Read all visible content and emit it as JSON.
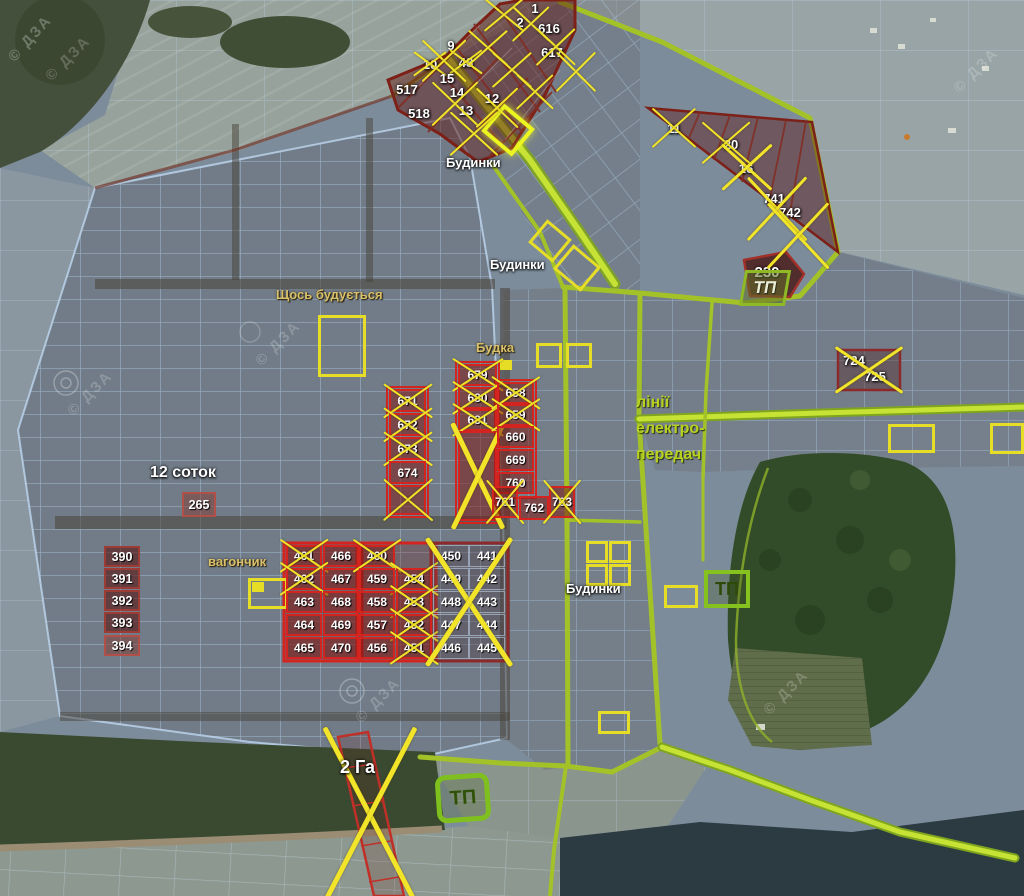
{
  "map_title": "Кадастрова схема земельних ділянок",
  "watermark_text": "© ДЗА",
  "colors": {
    "boundary_green": "#b6d42e",
    "crossed_yellow": "#f2e428",
    "plot_red": "#d42420",
    "plot_darkred": "#8b2a2a",
    "label_khaki": "#d9c06a",
    "power_line_green": "#b8d020"
  },
  "labels": [
    {
      "text": "Будинки",
      "x": 446,
      "y": 156,
      "cls": "white"
    },
    {
      "text": "Будинки",
      "x": 490,
      "y": 258,
      "cls": "white"
    },
    {
      "text": "Будинки",
      "x": 566,
      "y": 582,
      "cls": "white"
    },
    {
      "text": "Щось будується",
      "x": 276,
      "y": 288,
      "cls": "khaki"
    },
    {
      "text": "Будка",
      "x": 476,
      "y": 341,
      "cls": "khaki"
    },
    {
      "text": "вагончик",
      "x": 208,
      "y": 555,
      "cls": "khaki"
    },
    {
      "text": "12 соток",
      "x": 150,
      "y": 464,
      "cls": "big"
    },
    {
      "text": "2 Га",
      "x": 340,
      "y": 758,
      "cls": "big2"
    },
    {
      "text": "лінії",
      "x": 636,
      "y": 394,
      "cls": "green"
    },
    {
      "text": "електро-",
      "x": 636,
      "y": 420,
      "cls": "green"
    },
    {
      "text": "передач",
      "x": 636,
      "y": 446,
      "cls": "green"
    }
  ],
  "tp_stations": [
    {
      "label": "ТП",
      "x": 742,
      "y": 270,
      "w": 46,
      "h": 36,
      "variant": "trap"
    },
    {
      "label": "ТП",
      "x": 704,
      "y": 570,
      "w": 46,
      "h": 38,
      "variant": "square"
    },
    {
      "label": "ТП",
      "x": 436,
      "y": 774,
      "w": 54,
      "h": 48,
      "variant": "round"
    }
  ],
  "plots": [
    {
      "n": "1",
      "x": 526,
      "y": 1,
      "w": 18,
      "h": 14,
      "box": "bare",
      "crossed": false
    },
    {
      "n": "2",
      "x": 512,
      "y": 15,
      "w": 16,
      "h": 14,
      "box": "bare",
      "crossed": false
    },
    {
      "n": "616",
      "x": 534,
      "y": 21,
      "w": 30,
      "h": 15,
      "box": "bare",
      "crossed": false
    },
    {
      "n": "617",
      "x": 537,
      "y": 45,
      "w": 30,
      "h": 15,
      "box": "bare",
      "crossed": false
    },
    {
      "n": "9",
      "x": 443,
      "y": 38,
      "w": 16,
      "h": 14,
      "box": "bare",
      "crossed": false
    },
    {
      "n": "10",
      "x": 419,
      "y": 57,
      "w": 22,
      "h": 14,
      "box": "bare",
      "crossed": true
    },
    {
      "n": "48",
      "x": 455,
      "y": 55,
      "w": 22,
      "h": 14,
      "box": "bare",
      "crossed": true
    },
    {
      "n": "15",
      "x": 436,
      "y": 71,
      "w": 22,
      "h": 15,
      "box": "bare",
      "crossed": false
    },
    {
      "n": "14",
      "x": 446,
      "y": 85,
      "w": 22,
      "h": 14,
      "box": "bare",
      "crossed": false
    },
    {
      "n": "12",
      "x": 482,
      "y": 91,
      "w": 20,
      "h": 14,
      "box": "bare",
      "crossed": false
    },
    {
      "n": "13",
      "x": 455,
      "y": 103,
      "w": 22,
      "h": 14,
      "box": "bare",
      "crossed": false
    },
    {
      "n": "517",
      "x": 391,
      "y": 81,
      "w": 32,
      "h": 16,
      "box": "bare",
      "crossed": false
    },
    {
      "n": "518",
      "x": 403,
      "y": 105,
      "w": 32,
      "h": 16,
      "box": "bare",
      "crossed": false
    },
    {
      "n": "11",
      "x": 664,
      "y": 121,
      "w": 20,
      "h": 15,
      "box": "bare",
      "crossed": false
    },
    {
      "n": "20",
      "x": 720,
      "y": 137,
      "w": 22,
      "h": 15,
      "box": "bare",
      "crossed": false
    },
    {
      "n": "16",
      "x": 736,
      "y": 161,
      "w": 20,
      "h": 15,
      "box": "bare",
      "crossed": false
    },
    {
      "n": "741",
      "x": 760,
      "y": 191,
      "w": 28,
      "h": 15,
      "box": "bare",
      "crossed": false
    },
    {
      "n": "742",
      "x": 776,
      "y": 205,
      "w": 28,
      "h": 15,
      "box": "bare",
      "crossed": false
    },
    {
      "n": "230",
      "x": 750,
      "y": 263,
      "w": 34,
      "h": 18,
      "box": "bare-lg",
      "crossed": false
    },
    {
      "n": "724",
      "x": 841,
      "y": 353,
      "w": 26,
      "h": 14,
      "box": "bare",
      "crossed": false
    },
    {
      "n": "725",
      "x": 862,
      "y": 369,
      "w": 26,
      "h": 14,
      "box": "bare",
      "crossed": false
    },
    {
      "n": "671",
      "x": 389,
      "y": 389,
      "w": 37,
      "h": 23,
      "box": "red",
      "crossed": true
    },
    {
      "n": "672",
      "x": 389,
      "y": 413,
      "w": 37,
      "h": 23,
      "box": "red",
      "crossed": true
    },
    {
      "n": "673",
      "x": 389,
      "y": 437,
      "w": 37,
      "h": 23,
      "box": "red",
      "crossed": true
    },
    {
      "n": "674",
      "x": 389,
      "y": 461,
      "w": 37,
      "h": 23,
      "box": "red",
      "crossed": false
    },
    {
      "n": "",
      "x": 389,
      "y": 485,
      "w": 37,
      "h": 30,
      "box": "red",
      "crossed": true
    },
    {
      "n": "679",
      "x": 458,
      "y": 364,
      "w": 39,
      "h": 22,
      "box": "red",
      "crossed": true
    },
    {
      "n": "680",
      "x": 458,
      "y": 387,
      "w": 39,
      "h": 22,
      "box": "red",
      "crossed": true
    },
    {
      "n": "681",
      "x": 458,
      "y": 409,
      "w": 39,
      "h": 22,
      "box": "red",
      "crossed": true
    },
    {
      "n": "",
      "x": 458,
      "y": 431,
      "w": 39,
      "h": 90,
      "box": "red",
      "crossed": true
    },
    {
      "n": "658",
      "x": 497,
      "y": 382,
      "w": 37,
      "h": 22,
      "box": "red",
      "crossed": true
    },
    {
      "n": "659",
      "x": 497,
      "y": 404,
      "w": 37,
      "h": 22,
      "box": "red",
      "crossed": true
    },
    {
      "n": "660",
      "x": 497,
      "y": 426,
      "w": 37,
      "h": 22,
      "box": "red",
      "crossed": false
    },
    {
      "n": "669",
      "x": 497,
      "y": 449,
      "w": 37,
      "h": 22,
      "box": "red",
      "crossed": false
    },
    {
      "n": "760",
      "x": 497,
      "y": 472,
      "w": 37,
      "h": 22,
      "box": "red",
      "crossed": false
    },
    {
      "n": "761",
      "x": 492,
      "y": 486,
      "w": 26,
      "h": 32,
      "box": "red",
      "crossed": true
    },
    {
      "n": "762",
      "x": 519,
      "y": 496,
      "w": 30,
      "h": 24,
      "box": "red",
      "crossed": false
    },
    {
      "n": "763",
      "x": 549,
      "y": 486,
      "w": 26,
      "h": 32,
      "box": "red",
      "crossed": true
    },
    {
      "n": "265",
      "x": 182,
      "y": 492,
      "w": 34,
      "h": 25,
      "box": "darkred2",
      "crossed": false
    },
    {
      "n": "390",
      "x": 104,
      "y": 546,
      "w": 36,
      "h": 21,
      "box": "darkred",
      "crossed": false
    },
    {
      "n": "391",
      "x": 104,
      "y": 568,
      "w": 36,
      "h": 21,
      "box": "darkred",
      "crossed": false
    },
    {
      "n": "392",
      "x": 104,
      "y": 590,
      "w": 36,
      "h": 21,
      "box": "darkred",
      "crossed": false
    },
    {
      "n": "393",
      "x": 104,
      "y": 612,
      "w": 36,
      "h": 21,
      "box": "darkred",
      "crossed": false
    },
    {
      "n": "394",
      "x": 104,
      "y": 635,
      "w": 36,
      "h": 21,
      "box": "darkred2",
      "crossed": false
    },
    {
      "n": "461",
      "x": 286,
      "y": 545,
      "w": 36,
      "h": 22,
      "box": "red",
      "crossed": true
    },
    {
      "n": "466",
      "x": 323,
      "y": 545,
      "w": 36,
      "h": 22,
      "box": "red",
      "crossed": false
    },
    {
      "n": "462",
      "x": 286,
      "y": 568,
      "w": 36,
      "h": 22,
      "box": "red",
      "crossed": true
    },
    {
      "n": "467",
      "x": 323,
      "y": 568,
      "w": 36,
      "h": 22,
      "box": "red",
      "crossed": false
    },
    {
      "n": "463",
      "x": 286,
      "y": 591,
      "w": 36,
      "h": 22,
      "box": "red",
      "crossed": false
    },
    {
      "n": "468",
      "x": 323,
      "y": 591,
      "w": 36,
      "h": 22,
      "box": "red",
      "crossed": false
    },
    {
      "n": "464",
      "x": 286,
      "y": 614,
      "w": 36,
      "h": 22,
      "box": "red",
      "crossed": false
    },
    {
      "n": "469",
      "x": 323,
      "y": 614,
      "w": 36,
      "h": 22,
      "box": "red",
      "crossed": false
    },
    {
      "n": "465",
      "x": 286,
      "y": 637,
      "w": 36,
      "h": 22,
      "box": "red",
      "crossed": false
    },
    {
      "n": "470",
      "x": 323,
      "y": 637,
      "w": 36,
      "h": 22,
      "box": "red",
      "crossed": false
    },
    {
      "n": "460",
      "x": 359,
      "y": 545,
      "w": 36,
      "h": 22,
      "box": "red",
      "crossed": true
    },
    {
      "n": "459",
      "x": 359,
      "y": 568,
      "w": 36,
      "h": 22,
      "box": "red",
      "crossed": false
    },
    {
      "n": "454",
      "x": 396,
      "y": 568,
      "w": 36,
      "h": 22,
      "box": "red",
      "crossed": true
    },
    {
      "n": "458",
      "x": 359,
      "y": 591,
      "w": 36,
      "h": 22,
      "box": "red",
      "crossed": false
    },
    {
      "n": "453",
      "x": 396,
      "y": 591,
      "w": 36,
      "h": 22,
      "box": "red",
      "crossed": true
    },
    {
      "n": "457",
      "x": 359,
      "y": 614,
      "w": 36,
      "h": 22,
      "box": "red",
      "crossed": false
    },
    {
      "n": "452",
      "x": 396,
      "y": 614,
      "w": 36,
      "h": 22,
      "box": "red",
      "crossed": true
    },
    {
      "n": "456",
      "x": 359,
      "y": 637,
      "w": 36,
      "h": 22,
      "box": "red",
      "crossed": false
    },
    {
      "n": "451",
      "x": 396,
      "y": 637,
      "w": 36,
      "h": 22,
      "box": "red",
      "crossed": true
    },
    {
      "n": "450",
      "x": 433,
      "y": 545,
      "w": 36,
      "h": 22,
      "box": "cell",
      "crossed": false
    },
    {
      "n": "441",
      "x": 469,
      "y": 545,
      "w": 36,
      "h": 22,
      "box": "cell",
      "crossed": false
    },
    {
      "n": "449",
      "x": 433,
      "y": 568,
      "w": 36,
      "h": 22,
      "box": "cell",
      "crossed": false
    },
    {
      "n": "442",
      "x": 469,
      "y": 568,
      "w": 36,
      "h": 22,
      "box": "cell",
      "crossed": false
    },
    {
      "n": "448",
      "x": 433,
      "y": 591,
      "w": 36,
      "h": 22,
      "box": "cell",
      "crossed": false
    },
    {
      "n": "443",
      "x": 469,
      "y": 591,
      "w": 36,
      "h": 22,
      "box": "cell",
      "crossed": false
    },
    {
      "n": "447",
      "x": 433,
      "y": 614,
      "w": 36,
      "h": 22,
      "box": "cell",
      "crossed": false
    },
    {
      "n": "444",
      "x": 469,
      "y": 614,
      "w": 36,
      "h": 22,
      "box": "cell",
      "crossed": false
    },
    {
      "n": "446",
      "x": 433,
      "y": 637,
      "w": 36,
      "h": 22,
      "box": "cell",
      "crossed": false
    },
    {
      "n": "445",
      "x": 469,
      "y": 637,
      "w": 36,
      "h": 22,
      "box": "cell",
      "crossed": false
    }
  ],
  "xmarks": [
    [
      486,
      0,
      36,
      30
    ],
    [
      514,
      8,
      34,
      32
    ],
    [
      538,
      30,
      36,
      34
    ],
    [
      558,
      54,
      36,
      36
    ],
    [
      470,
      32,
      36,
      32
    ],
    [
      494,
      54,
      36,
      32
    ],
    [
      518,
      76,
      34,
      32
    ],
    [
      424,
      42,
      40,
      38
    ],
    [
      434,
      84,
      42,
      40
    ],
    [
      452,
      114,
      44,
      40
    ],
    [
      478,
      90,
      38,
      36
    ],
    [
      654,
      110,
      40,
      36
    ],
    [
      704,
      124,
      44,
      38
    ],
    [
      724,
      146,
      46,
      42
    ],
    [
      750,
      180,
      54,
      58
    ],
    [
      770,
      206,
      56,
      60
    ],
    [
      838,
      349,
      62,
      42
    ],
    [
      430,
      543,
      78,
      118
    ],
    [
      328,
      734,
      84,
      162
    ]
  ],
  "yellow_boxes": [
    [
      318,
      315,
      48,
      62,
      "outline",
      0
    ],
    [
      536,
      343,
      26,
      25,
      "outline",
      0
    ],
    [
      566,
      343,
      26,
      25,
      "outline",
      0
    ],
    [
      500,
      360,
      12,
      10,
      "filled",
      0
    ],
    [
      248,
      578,
      40,
      31,
      "outline",
      0
    ],
    [
      252,
      582,
      12,
      10,
      "filled",
      0
    ],
    [
      586,
      541,
      22,
      22,
      "outline",
      0
    ],
    [
      609,
      541,
      22,
      22,
      "outline",
      0
    ],
    [
      586,
      564,
      22,
      22,
      "outline",
      0
    ],
    [
      609,
      564,
      22,
      22,
      "outline",
      0
    ],
    [
      664,
      585,
      34,
      23,
      "outline",
      0
    ],
    [
      598,
      711,
      32,
      23,
      "outline",
      0
    ],
    [
      888,
      424,
      47,
      29,
      "outline",
      0
    ],
    [
      990,
      423,
      34,
      31,
      "outline",
      0
    ],
    [
      488,
      112,
      40,
      36,
      "bright",
      40
    ],
    [
      534,
      226,
      32,
      30,
      "outline",
      40
    ],
    [
      559,
      252,
      36,
      32,
      "outline",
      40
    ]
  ],
  "watermarks": [
    [
      40,
      50
    ],
    [
      250,
      335
    ],
    [
      62,
      385
    ],
    [
      350,
      692
    ],
    [
      948,
      62
    ],
    [
      758,
      684
    ]
  ]
}
